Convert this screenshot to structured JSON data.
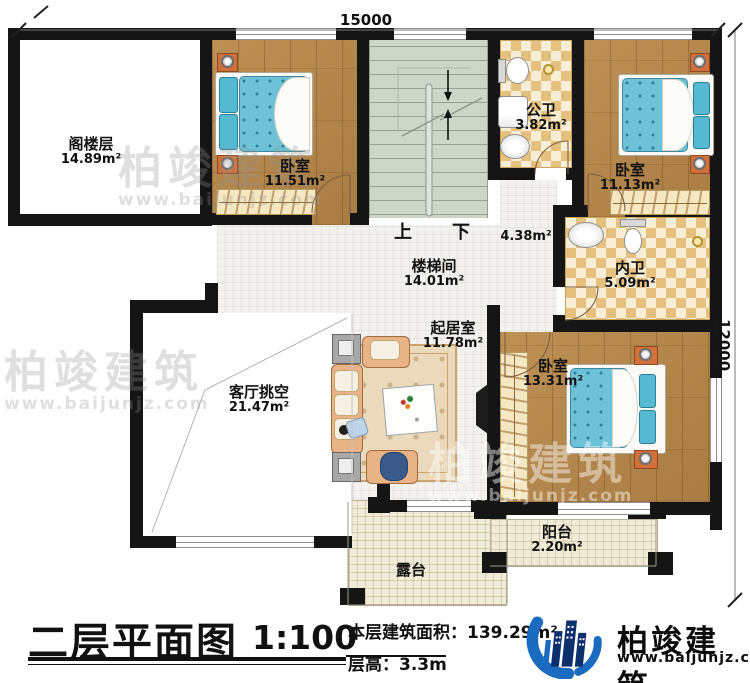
{
  "dimensions": {
    "top": "15000",
    "right": "12000"
  },
  "rooms": [
    {
      "name": "阁楼层",
      "area": "14.89m²"
    },
    {
      "name": "卧室",
      "area": "11.51m²"
    },
    {
      "name": "楼梯间",
      "area": "14.01m²"
    },
    {
      "name": "公卫",
      "area": "3.82m²"
    },
    {
      "name": "卧室",
      "area": "11.13m²"
    },
    {
      "name": "内卫",
      "area": "5.09m²"
    },
    {
      "name": "起居室",
      "area": "11.78m²"
    },
    {
      "name": "客厅挑空",
      "area": "21.47m²"
    },
    {
      "name": "卧室",
      "area": "13.31m²"
    },
    {
      "name": "阳台",
      "area": "2.20m²"
    },
    {
      "name": "露台"
    },
    {
      "area": "4.38m²"
    }
  ],
  "stairs": {
    "up": "上",
    "down": "下"
  },
  "title_block": {
    "title": "二层平面图",
    "scale": "1:100",
    "area_label": "本层建筑面积：",
    "area_value": "139.29m²",
    "floor_height_label": "层高：",
    "floor_height_value": "3.3m"
  },
  "brand": {
    "name": "柏竣建筑",
    "website": "www.baijunjz.com"
  },
  "watermark": {
    "text": "柏竣建筑",
    "website": "www.baijunjz.com"
  },
  "colors": {
    "wall": "#151515",
    "wood": "#b2854b",
    "bath_tile": "#e6c07f",
    "stair": "#cdd6c9",
    "outdoor": "#f1ecd7",
    "mattress": "#6ec2d8",
    "furniture_orange": "#d2703c",
    "brand_blue": "#1b6cc0",
    "brand_navy": "#0d2f6d"
  }
}
